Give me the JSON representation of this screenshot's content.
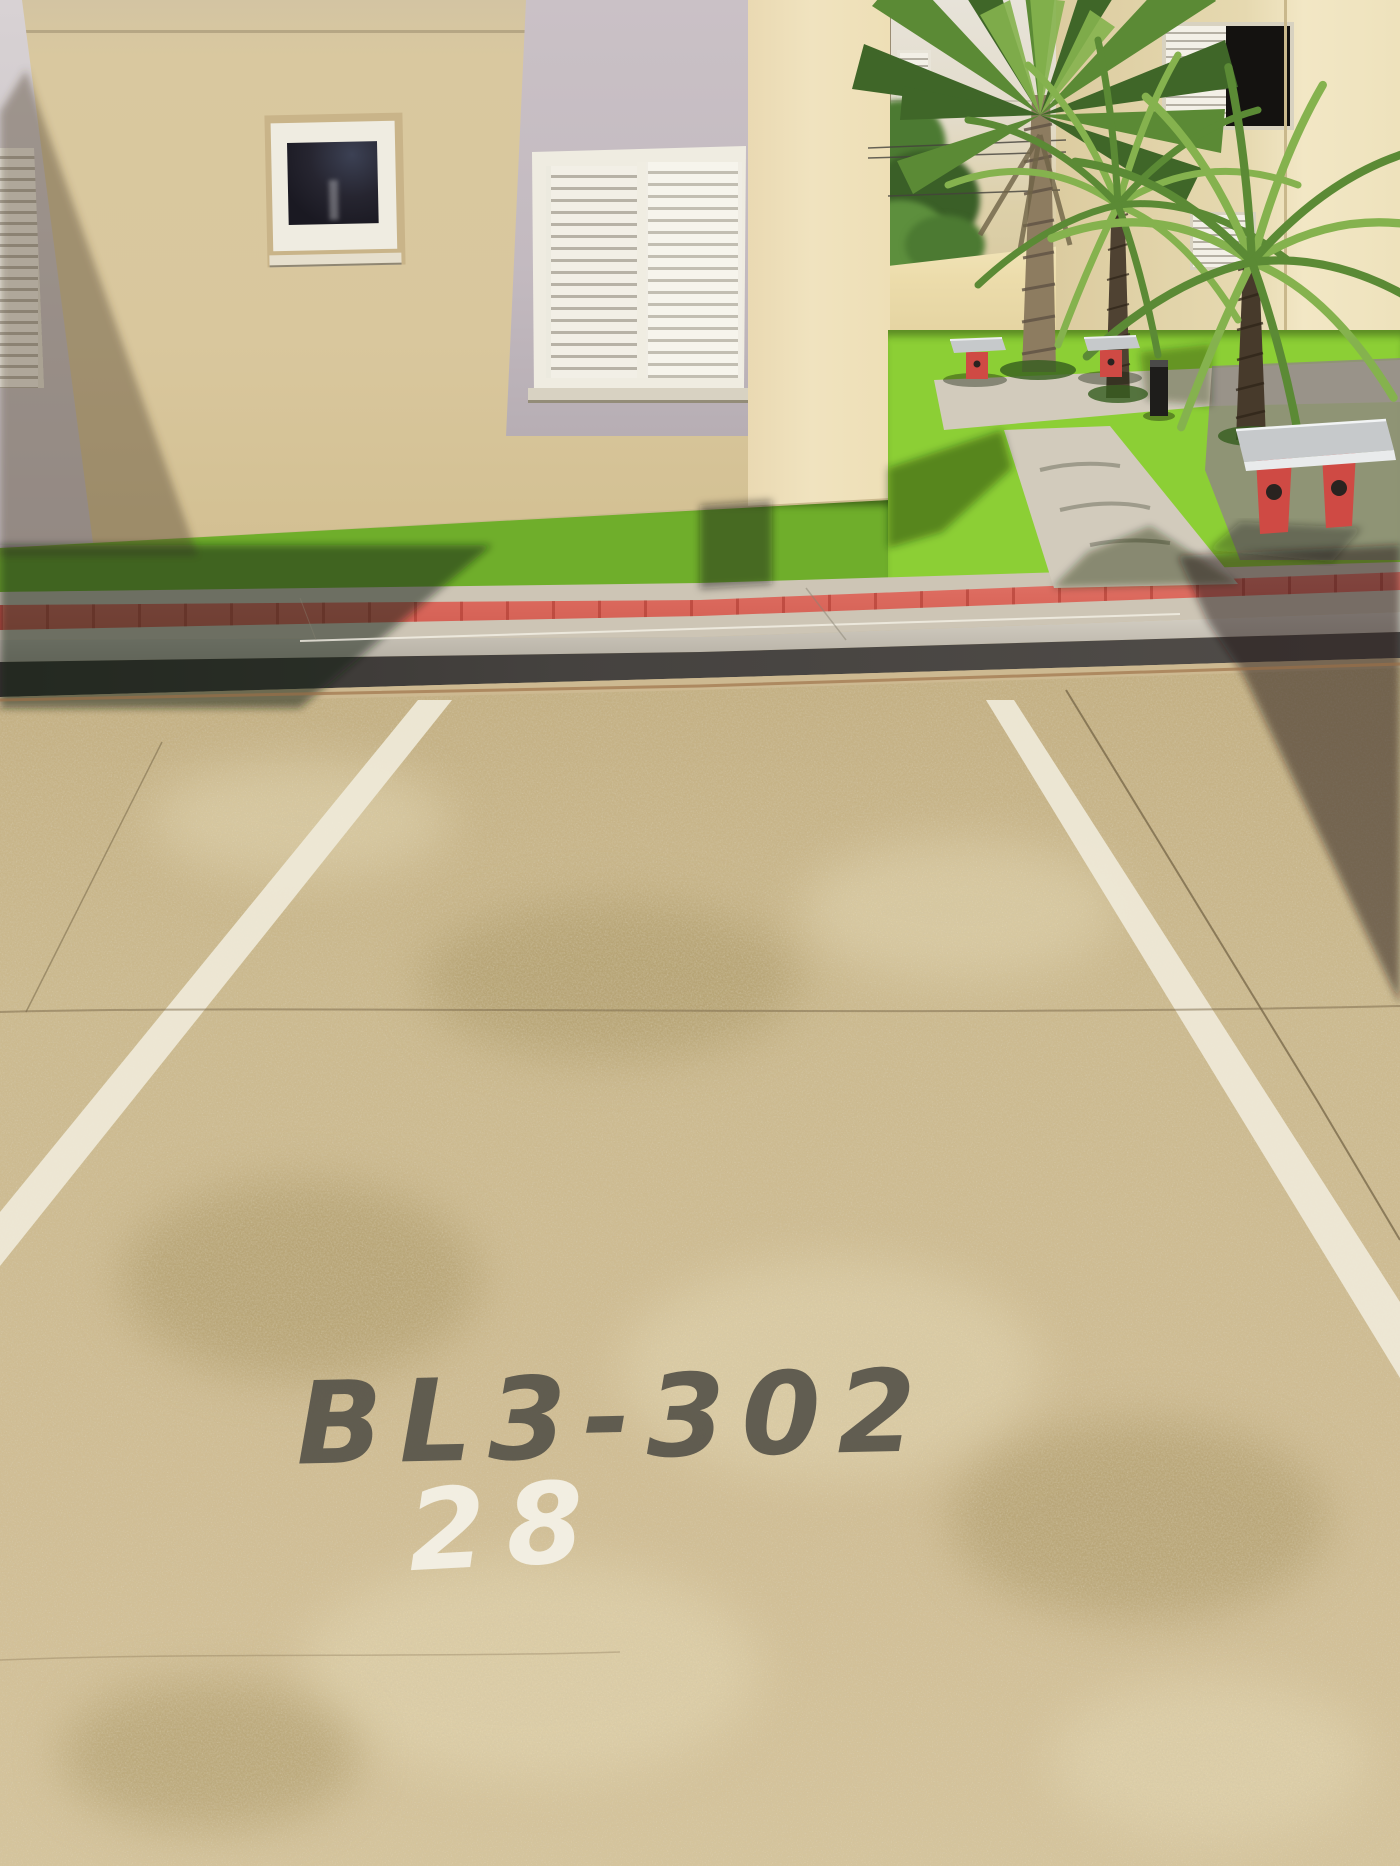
{
  "scene": {
    "type": "outdoor photograph",
    "setting": "numbered parking space in front of a condominium garden courtyard",
    "lighting": "bright sunlight with hard diagonal building shadows"
  },
  "pavement_markings": {
    "unit_label": "BL3-302",
    "space_number": "28"
  },
  "scene_elements": [
    "apartment building facade with beige and lavender panels",
    "small dark window with white frame",
    "large white louvered shutter window",
    "partial louvered shutter at left edge",
    "sunlit building corner column",
    "background apartment building with louvered windows",
    "power lines",
    "deciduous tree",
    "cream garden perimeter wall",
    "right-hand building with dark window opening",
    "tall fan palm",
    "two pygmy date palms",
    "bright artificial lawn with concrete paths",
    "two small concrete benches with red legs",
    "large concrete bench with red legs",
    "black bollard light",
    "shadowed grass strip",
    "sidewalk with red tactile paving stripe",
    "dark painted curb",
    "two white parking-bay lines",
    "expansion joints and cracks in pavement",
    "stenciled unit label in dark paint",
    "stenciled space number in white paint"
  ],
  "colors": {
    "sky": "#aed3e8",
    "bg_building": "#e7e3d9",
    "bg_building_warm": "#ddd0a9",
    "garden_wall": "#ecdcab",
    "right_building": "#dccca0",
    "right_building_bright": "#f2e7c5",
    "facade_beige": "#d9c79d",
    "lavender_panel": "#c3bac0",
    "lavender_panel_light": "#d8d2d4",
    "corner_column": "#f0e3bf",
    "frame_white": "#efece1",
    "louver_slat": "#f3f0e7",
    "louver_gap": "#b5b0a4",
    "window_glass": "#1a1922",
    "window_recess": "#c9b489",
    "grass_sunlit": "#6fae2b",
    "garden_grass": "#8ccf35",
    "path_sunlit": "#d2cbbc",
    "path_shadow": "#8f8a80",
    "red_stripe": "#dc6a5e",
    "sidewalk": "#cdc5b5",
    "curb_top_light": "#ddd8cd",
    "curb_top_dark": "#b0aa9e",
    "curb_face": "#45423f",
    "gutter": "#cdb991",
    "gutter_dirt": "#9b6f46",
    "pavement": "#cbb98e",
    "pavement_light": "#e6dab6",
    "pavement_dark": "#a4915f",
    "line_white": "#efe9d8",
    "stencil_dark": "#57544a",
    "stencil_white": "#f4f1e6",
    "bench_top": "#c6c9cb",
    "bench_leg": "#cf4a44",
    "bench_hole": "#2a2320",
    "bollard": "#1e1d1b",
    "palm_frond_dark": "#3f6628",
    "palm_frond_mid": "#5b8a35",
    "palm_frond_light": "#85b24e",
    "trunk_fan": "#8d7c60",
    "trunk_fan_dark": "#5f5244",
    "trunk_pygmy": "#4f4232",
    "tree_green": "#4c7a32",
    "tree_green_dark": "#3a5f27",
    "shadow_ground": "rgba(25,28,16,0.52)",
    "shadow_right": "rgba(30,28,24,0.5)",
    "shadow_wall": "rgba(80,64,42,0.42)"
  }
}
